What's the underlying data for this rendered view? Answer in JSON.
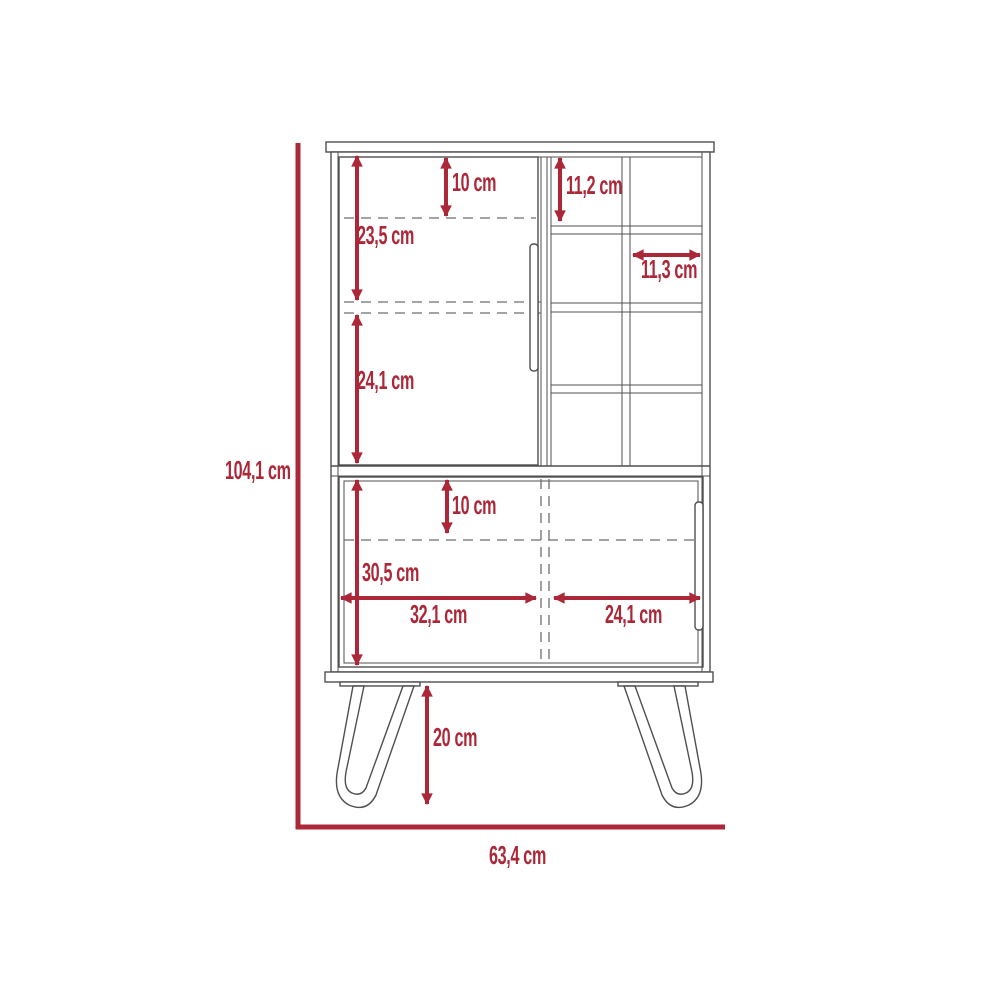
{
  "diagram": {
    "type": "furniture-dimension-drawing",
    "subject": "bar cabinet with upper door, cubby shelves, lower sliding doors and hairpin legs",
    "unit": "cm",
    "colors": {
      "dimension_accent": "#ac2738",
      "outline": "#4f4f4f",
      "background": "#ffffff"
    },
    "dimensions": {
      "overall_height": "104,1 cm",
      "overall_width": "63,4 cm",
      "upper_top_offset": "10 cm",
      "upper_shelf_a_height": "23,5 cm",
      "upper_shelf_b_height": "24,1 cm",
      "cubby_height": "11,2 cm",
      "cubby_width": "11,3 cm",
      "lower_top_offset": "10 cm",
      "lower_section_height": "30,5 cm",
      "lower_left_width": "32,1 cm",
      "lower_right_width": "24,1 cm",
      "leg_height": "20 cm"
    }
  }
}
